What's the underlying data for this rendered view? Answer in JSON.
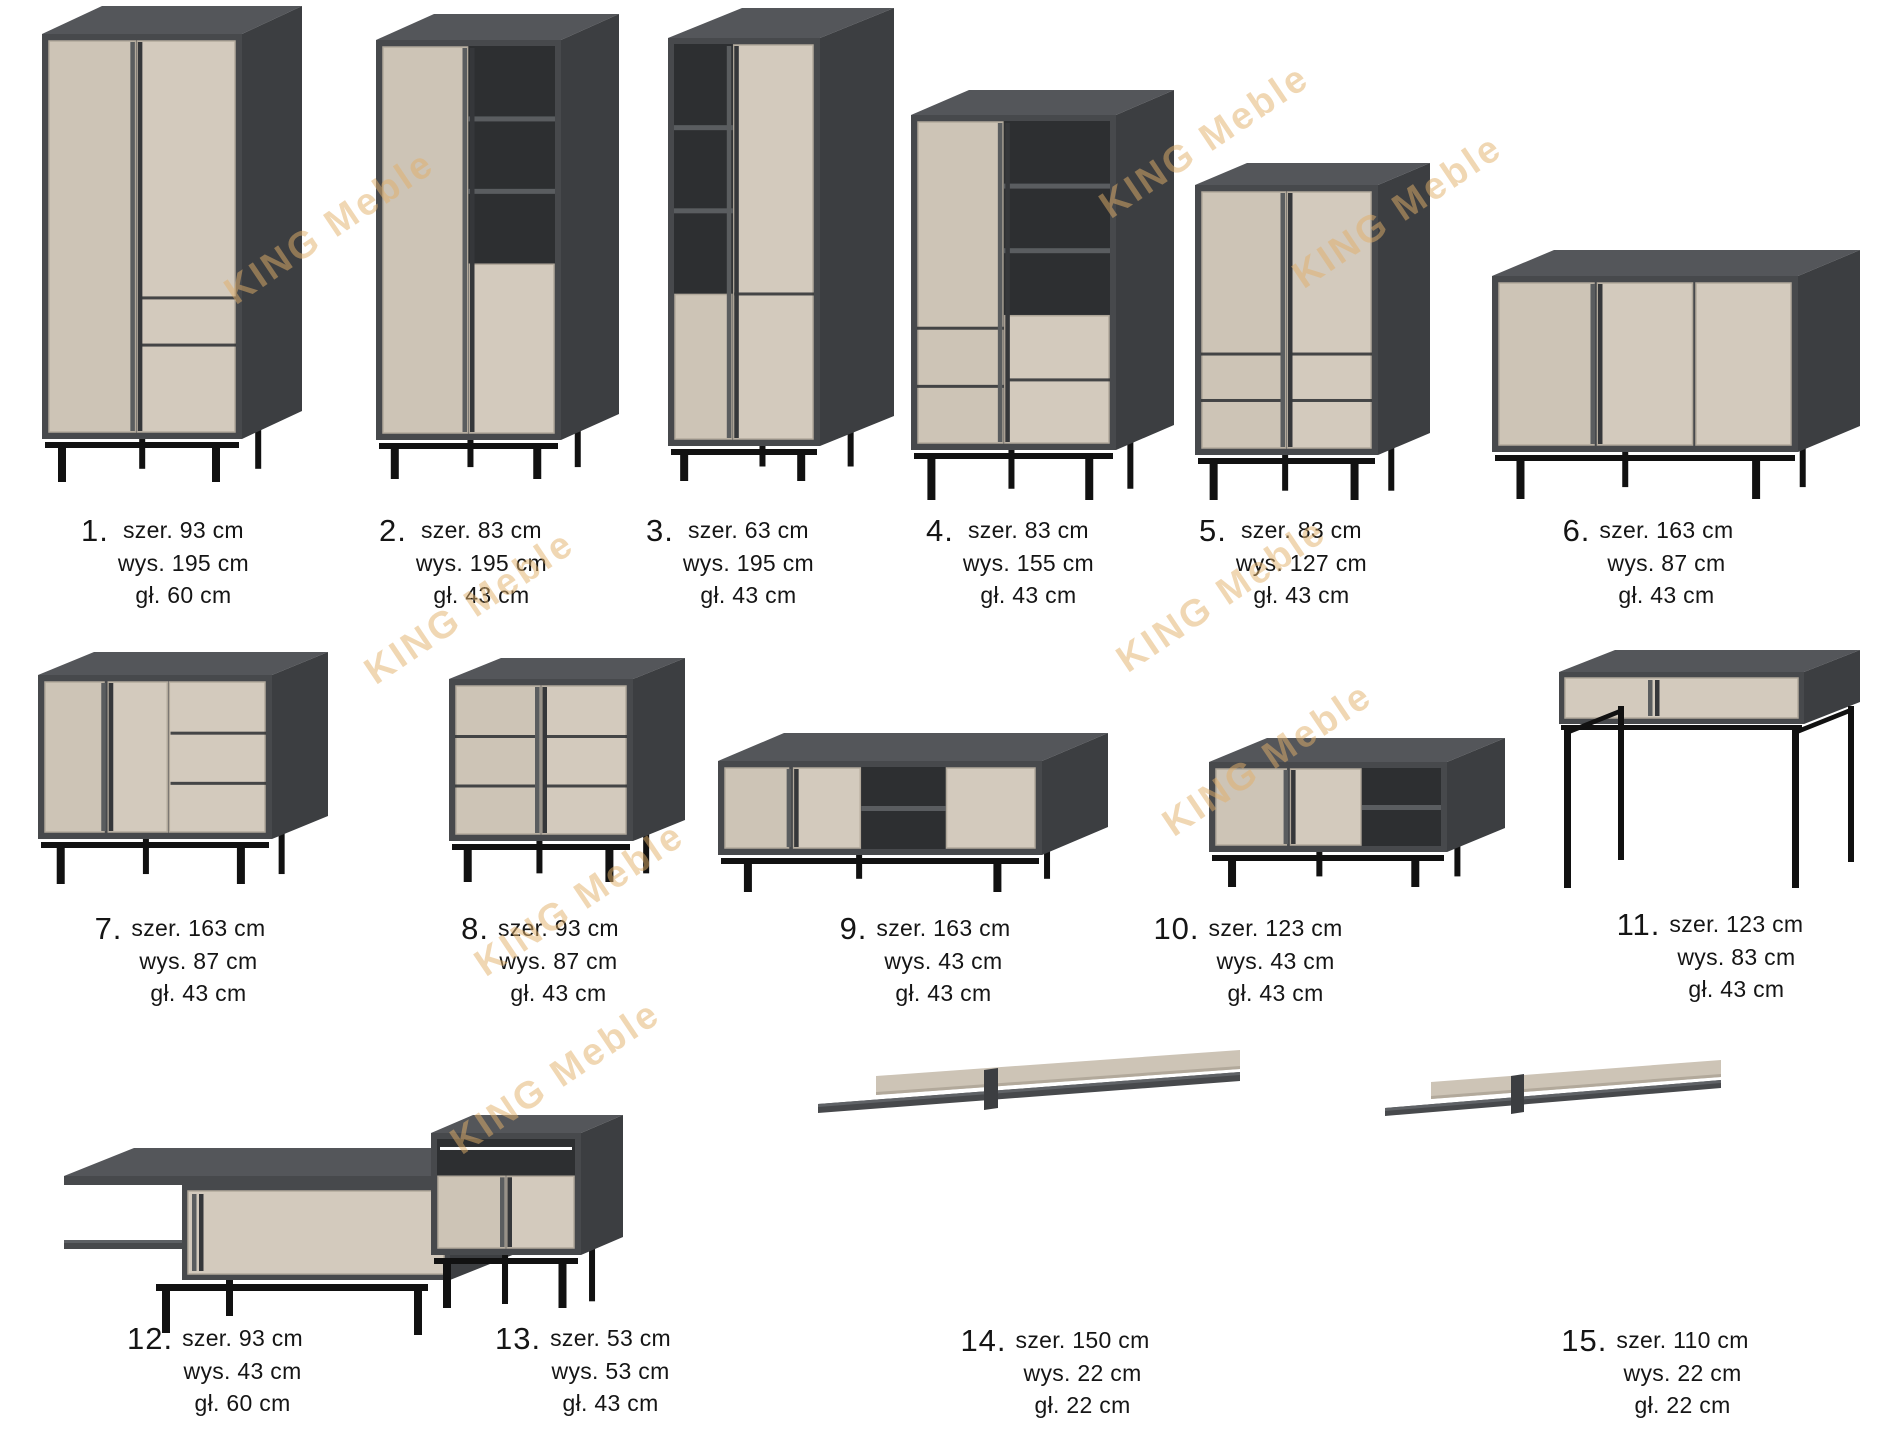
{
  "watermark": {
    "text": "KING Meble"
  },
  "colors": {
    "body_top": "#54565a",
    "body_side": "#3c3e41",
    "body_frame": "#47494c",
    "interior": "#2d2f31",
    "shelf_edge": "#5a5d60",
    "front_beige": "#cdc4b6",
    "front_beige_light": "#d3cabd",
    "front_edge": "#b2a99b",
    "handle_light": "#5a5d5f",
    "handle_dark": "#35373a",
    "legs_black": "#111111",
    "watermark_gold": "#e2b06a"
  },
  "items": [
    {
      "number": "1.",
      "kind": "wardrobe",
      "dims": [
        "szer. 93 cm",
        "wys. 195 cm",
        "gł. 60 cm"
      ]
    },
    {
      "number": "2.",
      "kind": "bookcase-cabinet",
      "dims": [
        "szer. 83 cm",
        "wys. 195 cm",
        "gł. 43 cm"
      ]
    },
    {
      "number": "3.",
      "kind": "narrow-bookcase",
      "dims": [
        "szer. 63 cm",
        "wys. 195 cm",
        "gł. 43 cm"
      ]
    },
    {
      "number": "4.",
      "kind": "display-cabinet",
      "dims": [
        "szer. 83 cm",
        "wys. 155 cm",
        "gł. 43 cm"
      ]
    },
    {
      "number": "5.",
      "kind": "two-door-cabinet",
      "dims": [
        "szer. 83 cm",
        "wys. 127 cm",
        "gł. 43 cm"
      ]
    },
    {
      "number": "6.",
      "kind": "sideboard",
      "dims": [
        "szer. 163 cm",
        "wys. 87 cm",
        "gł. 43 cm"
      ]
    },
    {
      "number": "7.",
      "kind": "sideboard-drawers",
      "dims": [
        "szer. 163 cm",
        "wys. 87 cm",
        "gł. 43 cm"
      ]
    },
    {
      "number": "8.",
      "kind": "chest-of-drawers",
      "dims": [
        "szer. 93 cm",
        "wys. 87 cm",
        "gł. 43 cm"
      ]
    },
    {
      "number": "9.",
      "kind": "tv-stand-large",
      "dims": [
        "szer. 163 cm",
        "wys. 43 cm",
        "gł. 43 cm"
      ]
    },
    {
      "number": "10.",
      "kind": "tv-stand-small",
      "dims": [
        "szer. 123 cm",
        "wys. 43 cm",
        "gł. 43 cm"
      ]
    },
    {
      "number": "11.",
      "kind": "console-table",
      "dims": [
        "szer. 123 cm",
        "wys. 83 cm",
        "gł. 43 cm"
      ]
    },
    {
      "number": "12.",
      "kind": "coffee-table",
      "dims": [
        "szer. 93 cm",
        "wys. 43 cm",
        "gł. 60 cm"
      ]
    },
    {
      "number": "13.",
      "kind": "bedside-table",
      "dims": [
        "szer. 53 cm",
        "wys. 53 cm",
        "gł. 43 cm"
      ]
    },
    {
      "number": "14.",
      "kind": "wall-shelf-long",
      "dims": [
        "szer. 150 cm",
        "wys. 22 cm",
        "gł. 22 cm"
      ]
    },
    {
      "number": "15.",
      "kind": "wall-shelf-short",
      "dims": [
        "szer. 110 cm",
        "wys. 22 cm",
        "gł. 22 cm"
      ]
    }
  ]
}
